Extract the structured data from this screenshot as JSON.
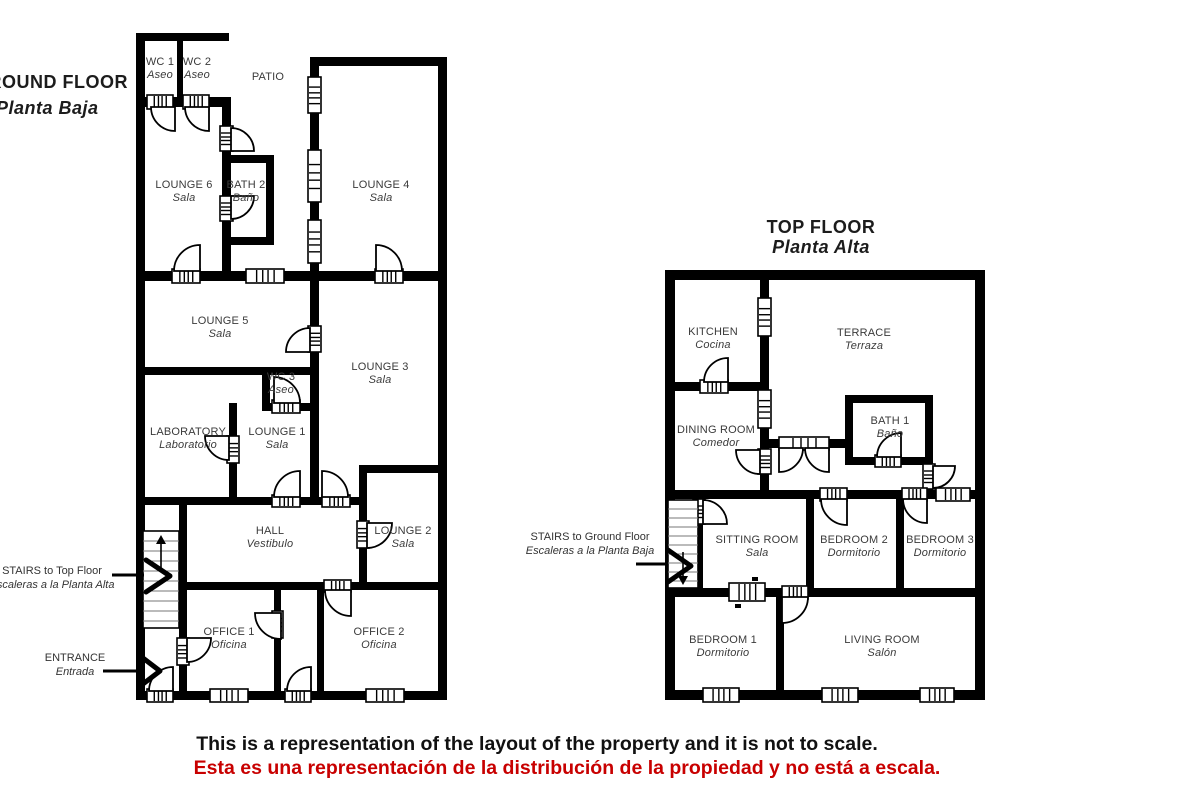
{
  "ground_floor": {
    "title": "GROUND FLOOR",
    "subtitle": "Planta Baja",
    "rooms": {
      "wc1": {
        "name": "WC 1",
        "sub": "Aseo"
      },
      "wc2": {
        "name": "WC 2",
        "sub": "Aseo"
      },
      "patio": {
        "name": "PATIO"
      },
      "lounge6": {
        "name": "LOUNGE 6",
        "sub": "Sala"
      },
      "bath2": {
        "name": "BATH 2",
        "sub": "Baño"
      },
      "lounge4": {
        "name": "LOUNGE 4",
        "sub": "Sala"
      },
      "lounge5": {
        "name": "LOUNGE 5",
        "sub": "Sala"
      },
      "wc3": {
        "name": "WC 3",
        "sub": "Aseo"
      },
      "lounge3": {
        "name": "LOUNGE 3",
        "sub": "Sala"
      },
      "laboratory": {
        "name": "LABORATORY",
        "sub": "Laboratorio"
      },
      "lounge1": {
        "name": "LOUNGE 1",
        "sub": "Sala"
      },
      "hall": {
        "name": "HALL",
        "sub": "Vestibulo"
      },
      "lounge2": {
        "name": "LOUNGE 2",
        "sub": "Sala"
      },
      "office1": {
        "name": "OFFICE 1",
        "sub": "Oficina"
      },
      "office2": {
        "name": "OFFICE 2",
        "sub": "Oficina"
      }
    },
    "annotations": {
      "stairs": {
        "line1": "STAIRS to Top Floor",
        "line2": "Escaleras a la Planta Alta"
      },
      "entrance": {
        "line1": "ENTRANCE",
        "line2": "Entrada"
      }
    }
  },
  "top_floor": {
    "title": "TOP FLOOR",
    "subtitle": "Planta Alta",
    "rooms": {
      "kitchen": {
        "name": "KITCHEN",
        "sub": "Cocina"
      },
      "terrace": {
        "name": "TERRACE",
        "sub": "Terraza"
      },
      "dining": {
        "name": "DINING ROOM",
        "sub": "Comedor"
      },
      "bath1": {
        "name": "BATH 1",
        "sub": "Baño"
      },
      "sitting": {
        "name": "SITTING ROOM",
        "sub": "Sala"
      },
      "bedroom2": {
        "name": "BEDROOM 2",
        "sub": "Dormitorio"
      },
      "bedroom3": {
        "name": "BEDROOM 3",
        "sub": "Dormitorio"
      },
      "bedroom1": {
        "name": "BEDROOM 1",
        "sub": "Dormitorio"
      },
      "living": {
        "name": "LIVING ROOM",
        "sub": "Salón"
      }
    },
    "annotations": {
      "stairs": {
        "line1": "STAIRS to Ground Floor",
        "line2": "Escaleras a la Planta Baja"
      }
    }
  },
  "disclaimer": {
    "en": "This is a representation of the layout of the property and it is not to scale.",
    "es": "Esta es una representación de la distribución de la propiedad y no está a escala.",
    "en_color": "#111111",
    "es_color": "#c80000"
  },
  "colors": {
    "wall": "#000000",
    "background": "#ffffff",
    "label_text": "#3a3a3a"
  }
}
